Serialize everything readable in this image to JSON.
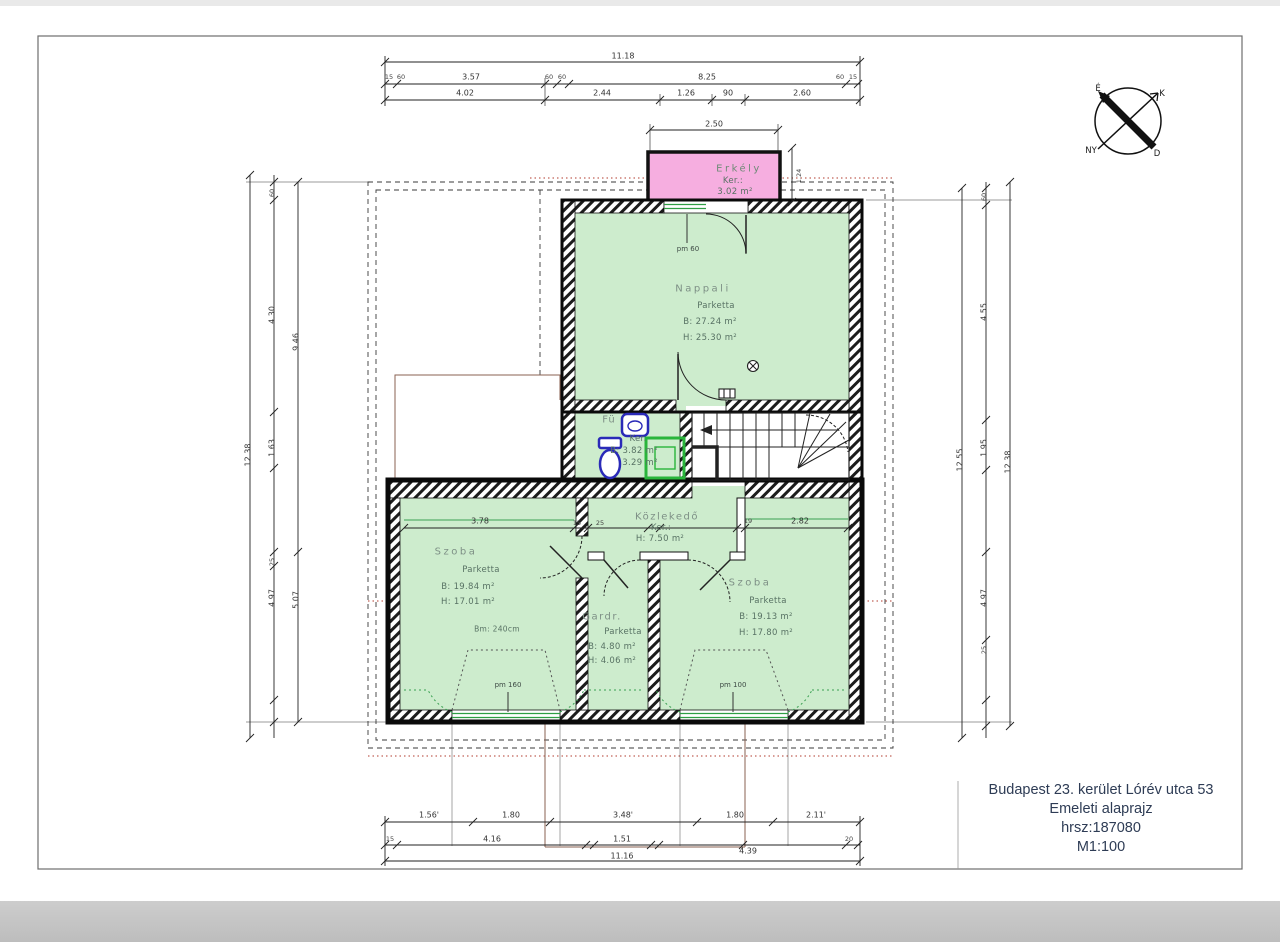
{
  "title_block": {
    "line1": "Budapest 23. kerület Lórév utca 53",
    "line2": "Emeleti alaprajz",
    "line3": "hrsz:187080",
    "line4": "M1:100"
  },
  "compass": {
    "north": "É",
    "east": "K",
    "west": "NY",
    "south": "D"
  },
  "colors": {
    "room_fill": "#cdeccd",
    "balcony_fill": "#f6aee0",
    "window_green": "#2f9e44",
    "section_red": "#b23b2e",
    "fixture_blue": "#2a2ab8",
    "title_text": "#2e3c55"
  },
  "rooms": {
    "erkely": {
      "name": "Erkély",
      "floor": "Ker.:",
      "area": "3.02 m²"
    },
    "nappali": {
      "name": "Nappali",
      "floor": "Parketta",
      "b": "B: 27.24 m²",
      "h": "H: 25.30 m²"
    },
    "furdo": {
      "name": "Fü",
      "floor": "Ker.",
      "b": "B: 3.82 m²",
      "h": "3.29 m²"
    },
    "kozlekedo": {
      "name": "Közlekedő",
      "floor": "Ker.:",
      "h": "H: 7.50 m²"
    },
    "szoba_l": {
      "name": "Szoba",
      "floor": "Parketta",
      "b": "B: 19.84 m²",
      "h": "H: 17.01 m²",
      "note": "Bm: 240cm"
    },
    "gardrob": {
      "name": "Gardr.",
      "floor": "Parketta",
      "b": "B: 4.80 m²",
      "h": "H: 4.06 m²"
    },
    "szoba_r": {
      "name": "Szoba",
      "floor": "Parketta",
      "b": "B: 19.13 m²",
      "h": "H: 17.80 m²"
    }
  },
  "window_labels": {
    "balcony": "pm 60",
    "left": "pm 160",
    "right": "pm 100"
  },
  "dims": {
    "top": {
      "total": "11.18",
      "t15a": "15",
      "t60a": "60",
      "r357": "3.57",
      "t60b": "60",
      "t60c": "60",
      "r825": "8.25",
      "t60d": "60",
      "t15b": "15",
      "r402": "4.02",
      "r244": "2.44",
      "r126": "1.26",
      "r90": "90",
      "r260": "2.60",
      "balc_w": "2.50",
      "balc_d": "1.24"
    },
    "bottom": {
      "b156": "1.56'",
      "b180a": "1.80",
      "b348": "3.48'",
      "b180b": "1.80",
      "b211": "2.11'",
      "b15": "15",
      "b416": "4.16",
      "b151": "1.51",
      "b439": "4.39",
      "b20": "20",
      "total": "11.16"
    },
    "left": {
      "total": "12.38",
      "s1": "4.30",
      "s2": "1.63",
      "s3": "4.97",
      "i1": "9.46",
      "i2": "5.07",
      "t60": "60",
      "t25": "25"
    },
    "right": {
      "total": "12.55",
      "s1": "4.55",
      "s2": "1.95",
      "s3": "4.97",
      "inner": "12.38",
      "t60": "60",
      "t25": "25"
    },
    "inner": {
      "a": "3.78",
      "b": "15",
      "c": "25",
      "d": "19",
      "e": "2.82"
    }
  }
}
